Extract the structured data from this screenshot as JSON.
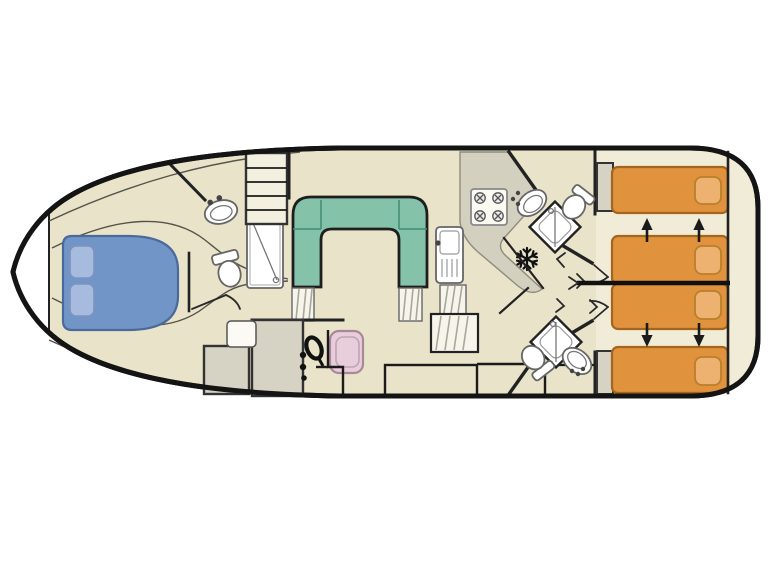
{
  "title": "boat-deck-plan",
  "colors": {
    "outline": "#141414",
    "wall": "#222222",
    "floor": "#e8e3c9",
    "bow_deck": "#ffffff",
    "aft_floor": "#f1ecd8",
    "counter": "#d3d0bf",
    "cabinet": "#d6d3c4",
    "bow_bed": "#7295c7",
    "bow_pillow": "#a6bbdd",
    "sofa": "#85c2aa",
    "sofa_seam": "#45917a",
    "berth": "#e0923c",
    "berth_pillow": "#edb170",
    "helm_seat": "#e8cddb",
    "fixture": "#ffffff",
    "stairs": "#f7f5eb"
  },
  "rooms": {
    "bow_cabin": {
      "bed": "double-bed",
      "pillows": 2
    },
    "forward_bathroom": {
      "fixtures": [
        "sink",
        "toilet",
        "shower"
      ],
      "ladder_rungs": 4
    },
    "saloon": {
      "sofa": "u-shaped-sofa",
      "steps": 2
    },
    "helm": {
      "fixtures": [
        "steering-wheel",
        "helm-seat"
      ]
    },
    "galley": {
      "fixtures": [
        "stove",
        "sink",
        "fridge"
      ],
      "burners": 4
    },
    "aft_bathroom_top": {
      "fixtures": [
        "sink",
        "shower",
        "toilet"
      ]
    },
    "aft_bathroom_bottom": {
      "fixtures": [
        "toilet",
        "shower",
        "sink"
      ]
    },
    "aft_cabins": {
      "berths": 4,
      "pillows": 4,
      "convert_arrows": 4
    }
  }
}
